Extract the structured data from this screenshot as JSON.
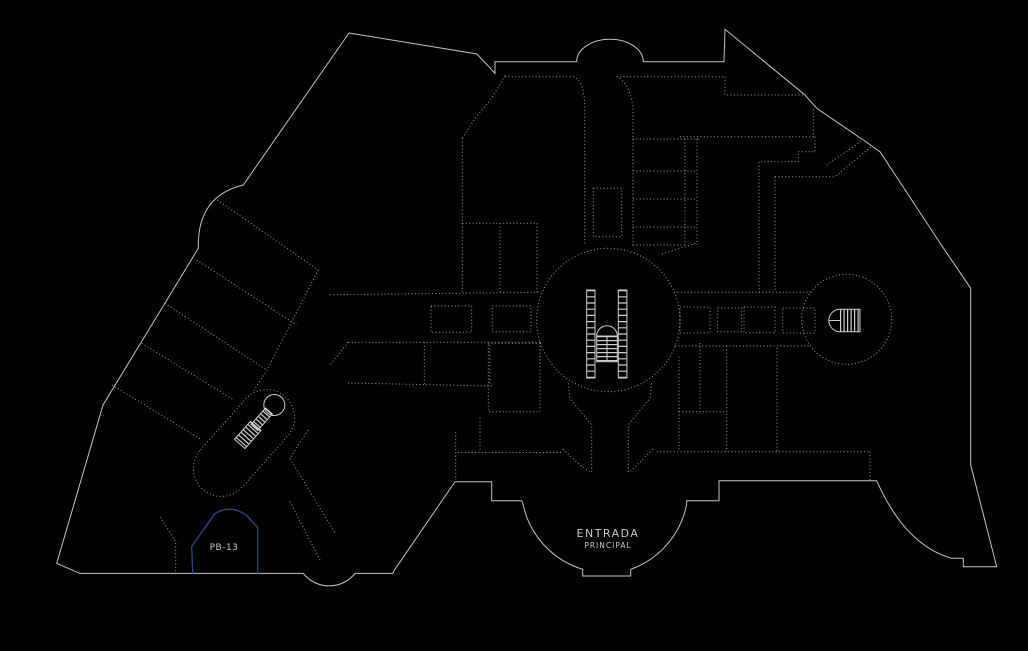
{
  "colors": {
    "background": "#000000",
    "wall": "#c4c4c4",
    "partition": "#9a9a9a",
    "fixture": "#cfcfcf",
    "highlight": "#2e4390",
    "label": "#c8c8c8"
  },
  "floor_plan": {
    "type": "mall-ground-floor-cad-plan",
    "labels": {
      "entrance_line1": "ENTRADA",
      "entrance_line2": "PRINCIPAL",
      "highlighted_room": "PB-13"
    },
    "highlighted_room": {
      "id": "PB-13",
      "outline_color": "#2e4390"
    },
    "icons": [
      "escalator-icon",
      "arched-staircase-icon",
      "spiral-staircase-icon",
      "switchback-staircase-icon"
    ]
  }
}
